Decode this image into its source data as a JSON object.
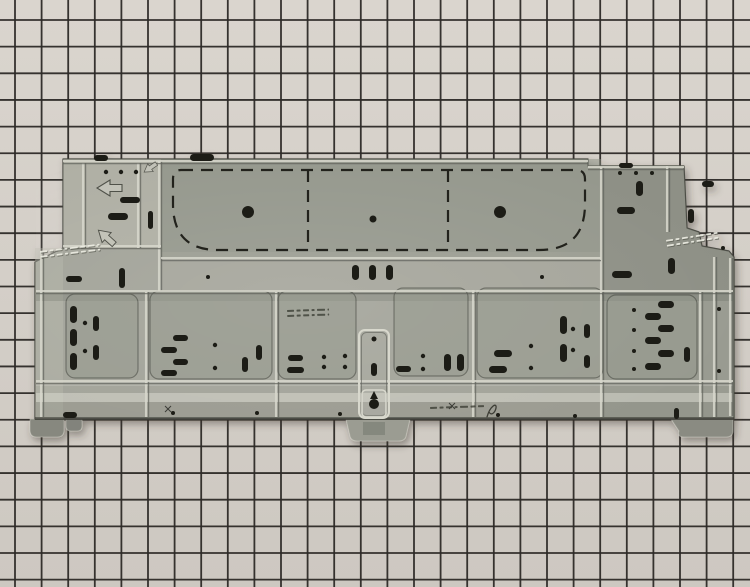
{
  "image": {
    "width": 750,
    "height": 587
  },
  "colors": {
    "paper": "#dad5ce",
    "paper2": "#cdc8c1",
    "gridline": "#2d2a27",
    "base": "#a2a399",
    "edge": "#45463f",
    "plateau": "#868b7f",
    "towerLight": "#c9c9be",
    "rightUpper": "#70736a",
    "rightLower": "#7c8076",
    "leftStrip": "#bdbdb2",
    "midStrip": "#aeaea3",
    "bandShadow": "#54554e",
    "sheen": "#dcdcd2",
    "sheenSoft": "#c9c9bf",
    "bottomStrip": "#8b8c82",
    "bottomEdge": "#3e3f38",
    "section": "#969a8d",
    "sectionEdge": "rgba(52,54,46,0.45)",
    "slot": "#1e1e18",
    "dash": "#23231d",
    "ribLight": "#d8d8cd",
    "ribDark": "#5f615a",
    "arrowFill": "#c6c6bb",
    "arrowEdge": "#50514a",
    "stampLight": "rgba(238,238,228,0.9)",
    "stampShadow": "rgba(75,76,66,0.6)",
    "stampPrinted": "rgba(58,59,50,0.78)",
    "markInk": "#3c3d36",
    "shadow": "rgba(55,53,48,0.45)"
  },
  "grid": {
    "offset_x": 15,
    "offset_y": 20,
    "step_x": 26.6,
    "step_y": 26.65,
    "line_width": 1.8
  },
  "panel": {
    "outline": "M63 159 L588 159 L588 166 L684 166 L687 228 L699 232 L702 246 L729 251 L734 257 L734 419 L35 419 L35 262 L63 248 Z",
    "feet": [
      {
        "d": "M30 419 L64 419 L64 430 Q64 437 57 437 L37 437 Q30 437 30 430 Z",
        "fill": "#87887f"
      },
      {
        "d": "M66 419 L82 419 L82 426 Q82 431 77 431 L71 431 Q66 431 66 426 Z",
        "fill": "#82837b"
      },
      {
        "d": "M346 419 L410 419 L406 436 Q405 441 398 441 L358 441 Q351 441 350 436 Z",
        "fill": "#9b9c92"
      },
      {
        "d": "M671 419 L733 419 L733 430 Q733 437 726 437 L684 437 Q677 437 679 431 Z",
        "fill": "#8a8b82"
      }
    ],
    "overlays": [
      {
        "type": "rect",
        "x": 161,
        "y": 159,
        "w": 440,
        "h": 100,
        "fill": "plateau",
        "op": 0.45
      },
      {
        "type": "rect",
        "x": 63,
        "y": 159,
        "w": 98,
        "h": 89,
        "fill": "towerLight",
        "op": 0.32
      },
      {
        "type": "poly",
        "points": "601,165 684,165 687,228 699,232 702,246 729,251 734,257 734,291 601,291",
        "fill": "rightUpper",
        "op": 0.4
      },
      {
        "type": "rect",
        "x": 601,
        "y": 291,
        "w": 133,
        "h": 127,
        "fill": "rightLower",
        "op": 0.22
      },
      {
        "type": "rect",
        "x": 35,
        "y": 248,
        "w": 28,
        "h": 171,
        "fill": "leftStrip",
        "op": 0.35
      },
      {
        "type": "rect",
        "x": 161,
        "y": 252,
        "w": 440,
        "h": 39,
        "fill": "midStrip",
        "op": 0.28
      },
      {
        "type": "rect",
        "x": 36,
        "y": 292,
        "w": 697,
        "h": 9,
        "fill": "bandShadow",
        "op": 0.22
      },
      {
        "type": "rect",
        "x": 36,
        "y": 381,
        "w": 697,
        "h": 5,
        "fill": "sheenSoft",
        "op": 0.38
      },
      {
        "type": "rect",
        "x": 36,
        "y": 393,
        "w": 697,
        "h": 9,
        "fill": "sheen",
        "op": 0.5
      },
      {
        "type": "rect",
        "x": 36,
        "y": 402,
        "w": 697,
        "h": 15,
        "fill": "bottomStrip",
        "op": 0.3
      },
      {
        "type": "rect",
        "x": 35,
        "y": 417,
        "w": 699,
        "h": 3,
        "fill": "bottomEdge",
        "op": 0.65
      },
      {
        "type": "rect",
        "x": 363,
        "y": 422,
        "w": 22,
        "h": 13,
        "fill": "rightUpper",
        "op": 0.5
      }
    ],
    "sections": [
      [
        66,
        294,
        72,
        84
      ],
      [
        150,
        291,
        122,
        88
      ],
      [
        278,
        291,
        78,
        88
      ],
      [
        394,
        288,
        74,
        88
      ],
      [
        477,
        288,
        126,
        90
      ],
      [
        607,
        295,
        90,
        84
      ]
    ],
    "vribs": [
      [
        41,
        252,
        417
      ],
      [
        83,
        163,
        248
      ],
      [
        138,
        163,
        248
      ],
      [
        146,
        292,
        417
      ],
      [
        159,
        161,
        291
      ],
      [
        276,
        292,
        417
      ],
      [
        473,
        290,
        417
      ],
      [
        601,
        167,
        417
      ],
      [
        667,
        166,
        232
      ],
      [
        700,
        292,
        417
      ],
      [
        714,
        257,
        417
      ],
      [
        730,
        258,
        416
      ]
    ],
    "hribs": [
      [
        161,
        63,
        588
      ],
      [
        167,
        588,
        684
      ],
      [
        246,
        63,
        161
      ],
      [
        258,
        161,
        601
      ],
      [
        291,
        36,
        733
      ],
      [
        381,
        36,
        733
      ]
    ],
    "knockout": {
      "outer": "M181 170 L576 170 Q585 170 585 179 L585 204 Q585 250 539 250 L218 250 Q173 250 173 204 L173 179 Q173 170 181 170 Z",
      "separators": [
        [
          308,
          170,
          250
        ],
        [
          448,
          170,
          250
        ]
      ],
      "dash": "12 8"
    },
    "channel": {
      "x": 359,
      "y": 330,
      "w": 30,
      "h": 88,
      "plate": [
        362,
        390,
        24,
        27
      ],
      "keyhole": {
        "cx": 374,
        "cy": 404,
        "r": 5,
        "tri": "370,399 378,399 374,391"
      },
      "screw_slot": [
        371,
        363,
        6,
        13
      ],
      "hole": [
        374,
        339,
        2.5
      ]
    },
    "slots": [
      [
        94,
        155,
        14,
        6
      ],
      [
        190,
        154,
        24,
        7
      ],
      [
        619,
        163,
        14,
        5
      ],
      [
        120,
        197,
        20,
        6
      ],
      [
        108,
        213,
        20,
        7
      ],
      [
        148,
        211,
        5,
        18
      ],
      [
        119,
        268,
        6,
        20
      ],
      [
        66,
        276,
        16,
        6
      ],
      [
        352,
        265,
        7,
        15
      ],
      [
        369,
        265,
        7,
        15
      ],
      [
        386,
        265,
        7,
        15
      ],
      [
        636,
        181,
        7,
        15
      ],
      [
        702,
        181,
        12,
        6
      ],
      [
        688,
        209,
        6,
        14
      ],
      [
        617,
        207,
        18,
        7
      ],
      [
        612,
        271,
        20,
        7
      ],
      [
        668,
        258,
        7,
        16
      ],
      [
        70,
        306,
        7,
        17
      ],
      [
        70,
        329,
        7,
        17
      ],
      [
        70,
        353,
        7,
        17
      ],
      [
        93,
        316,
        6,
        15
      ],
      [
        93,
        345,
        6,
        15
      ],
      [
        173,
        335,
        15,
        6
      ],
      [
        161,
        347,
        16,
        6
      ],
      [
        173,
        359,
        15,
        6
      ],
      [
        161,
        370,
        16,
        6
      ],
      [
        242,
        357,
        6,
        15
      ],
      [
        256,
        345,
        6,
        15
      ],
      [
        288,
        355,
        15,
        6
      ],
      [
        287,
        367,
        17,
        6
      ],
      [
        396,
        366,
        15,
        6
      ],
      [
        444,
        354,
        7,
        17
      ],
      [
        457,
        354,
        7,
        17
      ],
      [
        494,
        350,
        18,
        7
      ],
      [
        489,
        366,
        18,
        7
      ],
      [
        560,
        316,
        7,
        18
      ],
      [
        560,
        344,
        7,
        18
      ],
      [
        584,
        324,
        6,
        14
      ],
      [
        584,
        355,
        6,
        13
      ],
      [
        658,
        301,
        16,
        7
      ],
      [
        645,
        313,
        16,
        7
      ],
      [
        658,
        325,
        16,
        7
      ],
      [
        645,
        337,
        16,
        7
      ],
      [
        658,
        350,
        16,
        7
      ],
      [
        645,
        363,
        16,
        7
      ],
      [
        684,
        347,
        6,
        15
      ],
      [
        63,
        412,
        14,
        6
      ],
      [
        674,
        408,
        5,
        11
      ]
    ],
    "holes": [
      [
        106,
        172,
        2.2
      ],
      [
        121,
        172,
        2.2
      ],
      [
        136,
        172,
        2.2
      ],
      [
        248,
        212,
        6
      ],
      [
        373,
        219,
        3.5
      ],
      [
        500,
        212,
        6
      ],
      [
        620,
        173,
        2
      ],
      [
        636,
        173,
        2
      ],
      [
        652,
        173,
        2
      ],
      [
        723,
        248,
        2
      ],
      [
        208,
        277,
        2
      ],
      [
        542,
        277,
        2
      ],
      [
        85,
        323,
        2.2
      ],
      [
        85,
        351,
        2.2
      ],
      [
        215,
        345,
        2.2
      ],
      [
        215,
        368,
        2.2
      ],
      [
        324,
        357,
        2.2
      ],
      [
        324,
        367,
        2.2
      ],
      [
        345,
        356,
        2.2
      ],
      [
        345,
        367,
        2.2
      ],
      [
        423,
        356,
        2.2
      ],
      [
        423,
        369,
        2.2
      ],
      [
        531,
        346,
        2.2
      ],
      [
        531,
        368,
        2.2
      ],
      [
        573,
        329,
        2.2
      ],
      [
        573,
        350,
        2.2
      ],
      [
        634,
        310,
        2
      ],
      [
        634,
        330,
        2
      ],
      [
        634,
        351,
        2
      ],
      [
        634,
        369,
        2
      ],
      [
        719,
        309,
        2
      ],
      [
        719,
        371,
        2
      ],
      [
        173,
        413,
        2
      ],
      [
        257,
        413,
        2
      ],
      [
        340,
        414,
        2
      ],
      [
        498,
        415,
        2
      ],
      [
        575,
        416,
        2
      ]
    ],
    "arrows": [
      {
        "x": 109,
        "y": 188,
        "rot": 0,
        "scale": 1
      },
      {
        "x": 150,
        "y": 168,
        "rot": -35,
        "scale": 0.6
      },
      {
        "x": 106,
        "y": 237,
        "rot": 42,
        "scale": 0.85
      }
    ],
    "stamps": [
      {
        "x": 40,
        "y": 251,
        "w": 60,
        "rows": 2,
        "rot": -7,
        "style": "embossed"
      },
      {
        "x": 287,
        "y": 310,
        "w": 42,
        "rows": 2,
        "rot": -2,
        "style": "printed"
      },
      {
        "x": 430,
        "y": 407,
        "w": 54,
        "rows": 1,
        "rot": -2,
        "style": "printed"
      },
      {
        "x": 666,
        "y": 240,
        "w": 52,
        "rows": 2,
        "rot": -9,
        "style": "embossed"
      }
    ],
    "xmarks": [
      [
        168,
        409
      ],
      [
        452,
        406
      ]
    ],
    "squiggle": "M487 417 C490 406 497 402 496 408 C495 413 491 416 489 412"
  }
}
